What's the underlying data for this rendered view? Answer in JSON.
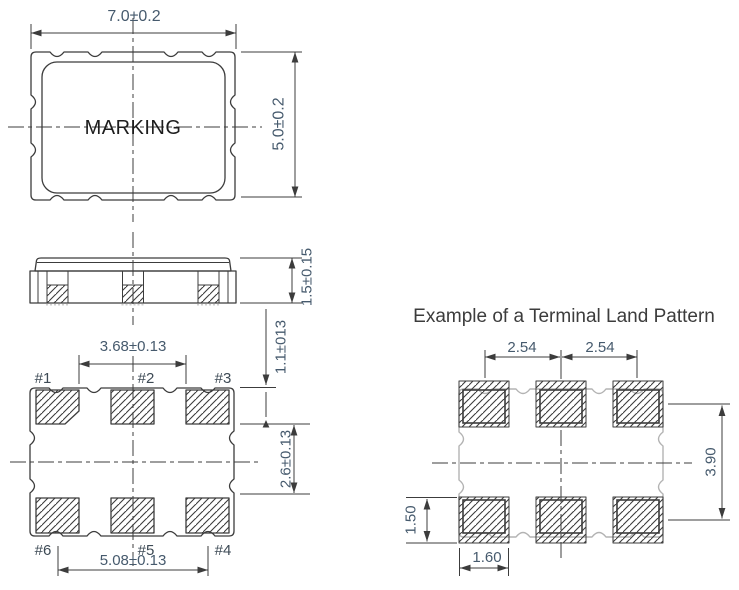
{
  "colors": {
    "line": "#3c3c3c",
    "dimension_text": "#465a6d",
    "ghost_outline": "#b3b3b3",
    "marking_text": "#1d1d1d",
    "background": "#ffffff"
  },
  "top_view": {
    "marking": "MARKING",
    "dim_width": "7.0±0.2",
    "dim_height": "5.0±0.2"
  },
  "side_view": {
    "dim_height": "1.5±0.15"
  },
  "bottom_view": {
    "dim_pads_inner_span": "3.68±0.13",
    "dim_pads_outer_span": "5.08±0.13",
    "dim_edge_offset": "1.1±013",
    "dim_row_gap": "2.6±0.13",
    "pad_labels": {
      "p1": "#1",
      "p2": "#2",
      "p3": "#3",
      "p4": "#4",
      "p5": "#5",
      "p6": "#6"
    }
  },
  "land_pattern": {
    "title": "Example of a Terminal Land Pattern",
    "dim_pitch_left": "2.54",
    "dim_pitch_right": "2.54",
    "dim_row_pitch": "3.90",
    "dim_pad_height": "1.50",
    "dim_pad_width": "1.60"
  }
}
